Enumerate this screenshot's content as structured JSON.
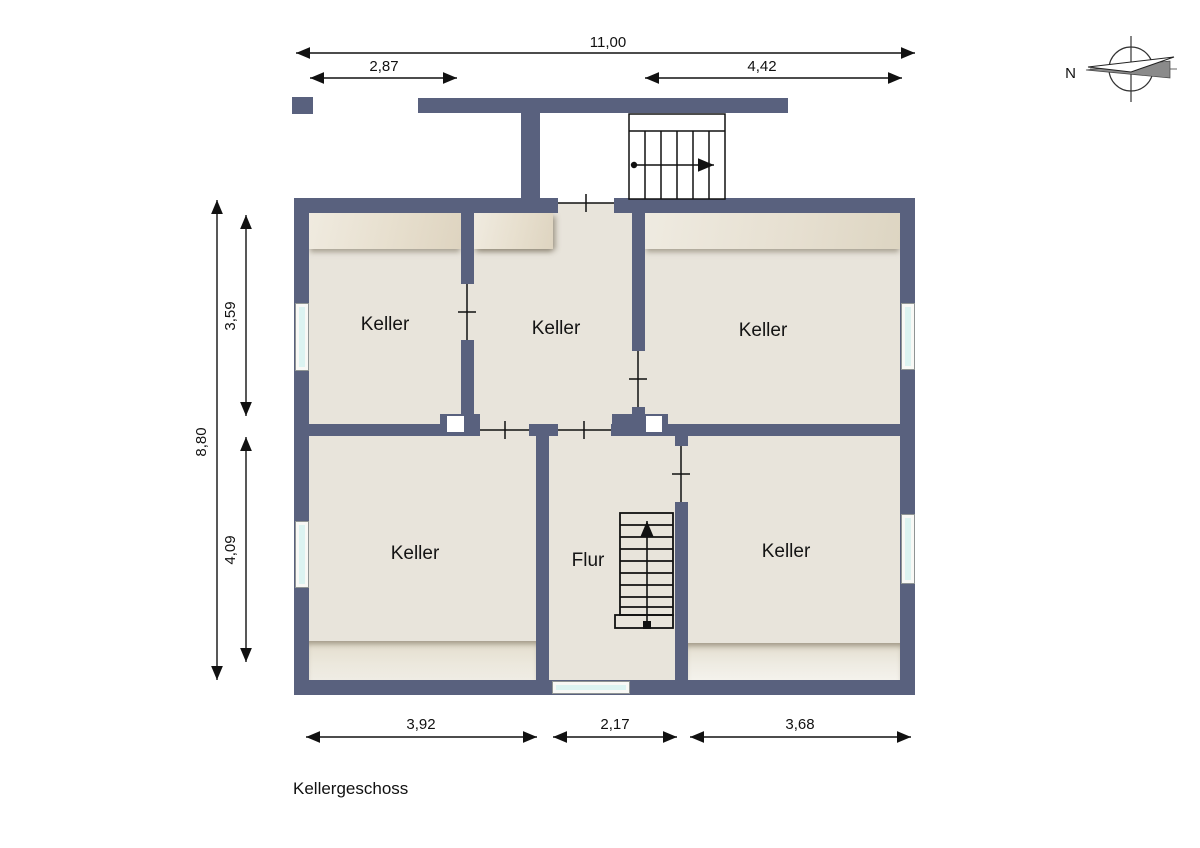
{
  "floor_plan": {
    "title": "Kellergeschoss",
    "compass_label": "N",
    "rooms": [
      {
        "id": "keller-top-left",
        "label": "Keller"
      },
      {
        "id": "keller-middle",
        "label": "Keller"
      },
      {
        "id": "keller-top-right",
        "label": "Keller"
      },
      {
        "id": "keller-bottom-left",
        "label": "Keller"
      },
      {
        "id": "flur",
        "label": "Flur"
      },
      {
        "id": "keller-bottom-right",
        "label": "Keller"
      }
    ],
    "dimensions_m": {
      "total_width": "11,00",
      "top_left_width": "2,87",
      "top_right_width": "4,42",
      "total_height": "8,80",
      "upper_height": "3,59",
      "lower_height": "4,09",
      "bottom_left_width": "3,92",
      "bottom_middle_width": "2,17",
      "bottom_right_width": "3,68"
    },
    "colors": {
      "wall": "#59617e",
      "floor": "#e8e4db",
      "window_glass": "#dcf3f1",
      "line": "#111111"
    }
  }
}
